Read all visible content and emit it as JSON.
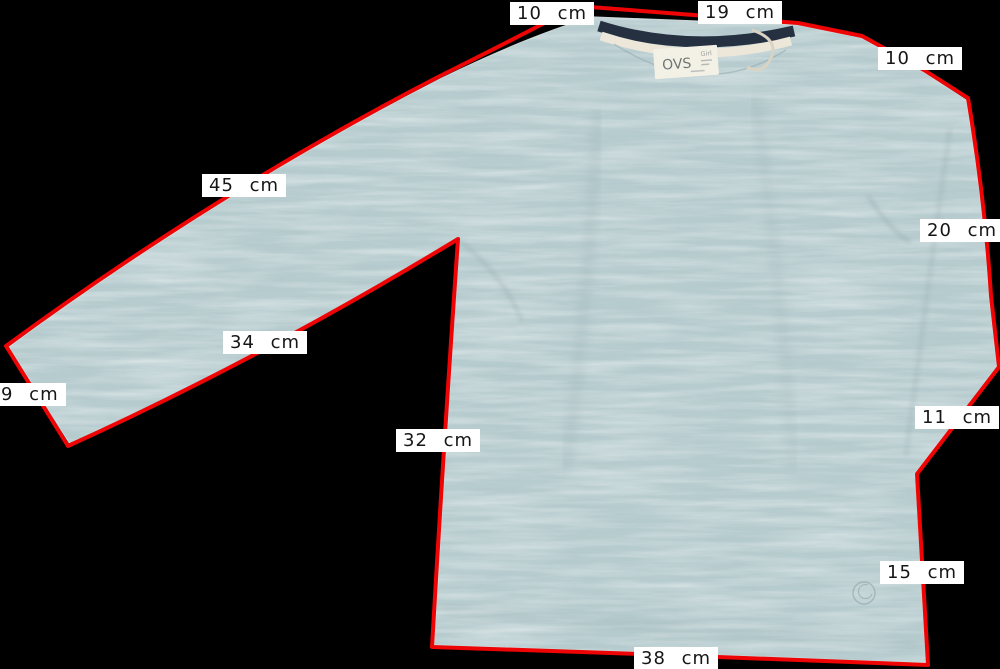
{
  "background_color": "#000000",
  "colors": {
    "fabric": "#b7cccf",
    "fabric_shadow": "#8fa6ab",
    "collar_navy": "#253141",
    "collar_trim": "#ece7d9",
    "outline_red": "#ee0404",
    "label_bg": "#ffffff",
    "label_text": "#161616",
    "tag_bg": "#f3f0e6",
    "tag_text": "#707572"
  },
  "garment_tag": {
    "brand": "OVS",
    "line": "Girl"
  },
  "measurements": [
    {
      "id": "shoulder-left",
      "text": "10 cm"
    },
    {
      "id": "neck-width",
      "text": "19 cm"
    },
    {
      "id": "shoulder-right",
      "text": "10 cm"
    },
    {
      "id": "sleeve-top-left",
      "text": "45 cm"
    },
    {
      "id": "sleeve-right",
      "text": "20 cm"
    },
    {
      "id": "sleeve-under-left",
      "text": "34 cm"
    },
    {
      "id": "cuff-left",
      "text": "9 cm"
    },
    {
      "id": "side-left",
      "text": "32 cm"
    },
    {
      "id": "cuff-right",
      "text": "11 cm"
    },
    {
      "id": "side-right",
      "text": "15 cm"
    },
    {
      "id": "hem-width",
      "text": "38 cm"
    }
  ]
}
